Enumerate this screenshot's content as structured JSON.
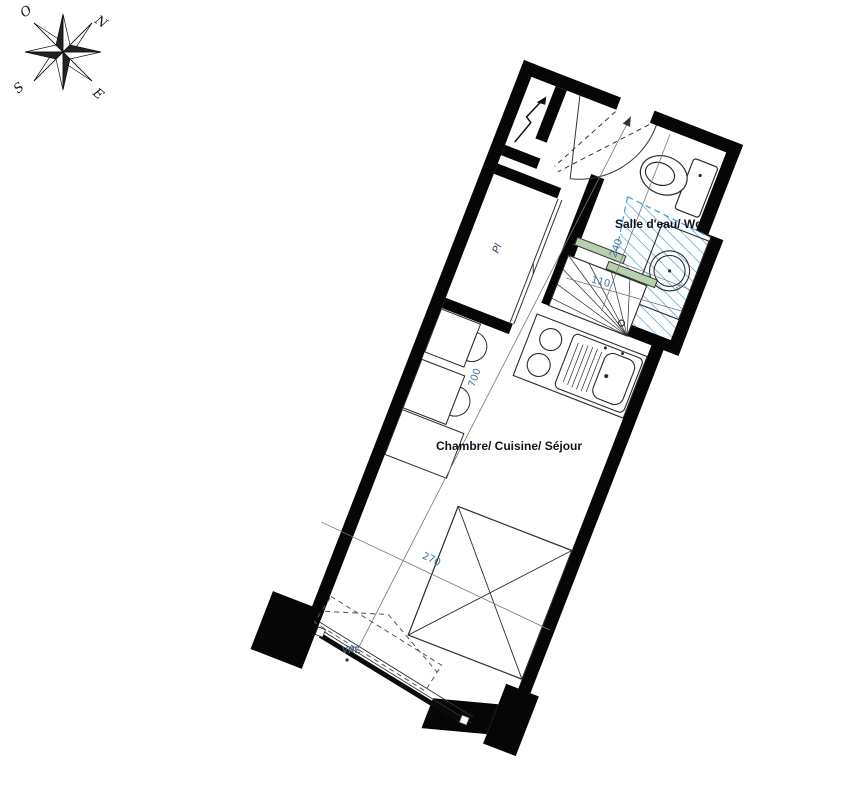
{
  "compass": {
    "north": "N",
    "west": "O",
    "south": "S",
    "east": "E"
  },
  "rooms": {
    "bathroom_label": "Salle d'eau/ Wc",
    "main_room_label": "Chambre/ Cuisine/ Séjour",
    "closet_label": "Pl"
  },
  "dimensions": {
    "main_room_length_cm": "700",
    "main_room_width_cm": "270",
    "bathroom_length_cm": "240",
    "bathroom_width_cm": "110",
    "basin_note": "40"
  },
  "annotations": {
    "window_label": "VRE"
  },
  "colors": {
    "wall": "#060606",
    "fixture_line": "#2b2b2b",
    "dimension": "#4a74a0",
    "hatch_blue": "#3f9ad6",
    "screen_green": "#b8cfae"
  }
}
